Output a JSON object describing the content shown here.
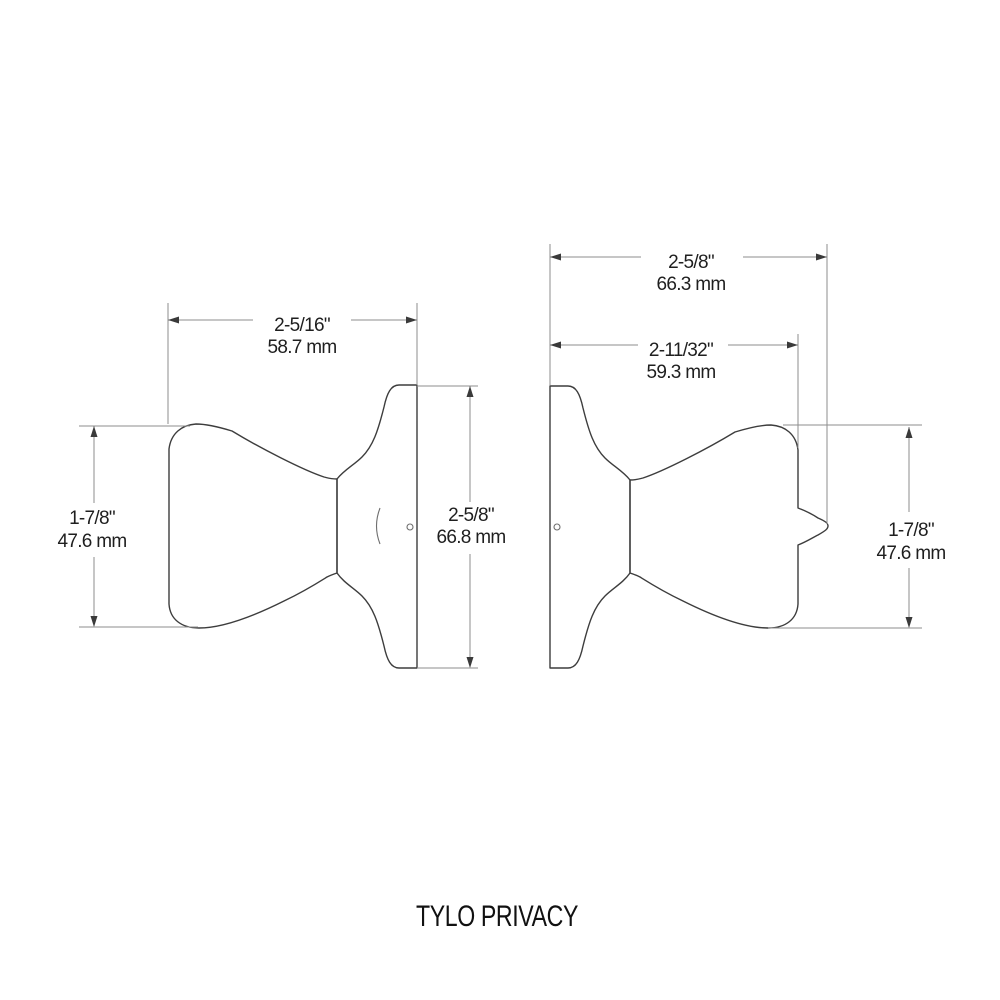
{
  "title": "TYLO PRIVACY",
  "colors": {
    "background": "#ffffff",
    "outline": "#3d3d3d",
    "dimension_lines": "#8d8d8d",
    "text": "#1f1f1f"
  },
  "views": {
    "exterior_knob": {
      "description": "left side view - exterior knob with rose plate on right",
      "projection": {
        "inches": "2-5/16\"",
        "mm": "58.7 mm"
      },
      "knob_diameter": {
        "inches": "1-7/8\"",
        "mm": "47.6 mm"
      },
      "rose_diameter": {
        "inches": "2-5/8\"",
        "mm": "66.8 mm"
      }
    },
    "interior_knob": {
      "description": "right side view - interior knob with privacy turn button",
      "overall_projection": {
        "inches": "2-5/8\"",
        "mm": "66.3 mm"
      },
      "knob_projection": {
        "inches": "2-11/32\"",
        "mm": "59.3 mm"
      },
      "knob_diameter": {
        "inches": "1-7/8\"",
        "mm": "47.6 mm"
      }
    }
  }
}
